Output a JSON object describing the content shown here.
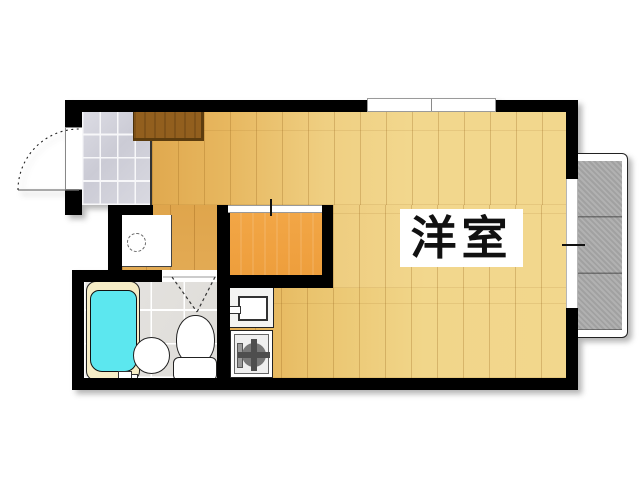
{
  "floorplan": {
    "rooms": {
      "main": {
        "label": "洋室"
      }
    },
    "fixtures": [
      "entrance-door",
      "genkan-tile",
      "shoe-cabinet",
      "washing-machine-space",
      "closet",
      "kitchen-sink",
      "gas-stove",
      "bathtub",
      "washbasin",
      "toilet",
      "bathroom-folding-door",
      "top-window",
      "balcony-window",
      "balcony"
    ],
    "colors": {
      "wall": "#000000",
      "wood_light": "#f2d78d",
      "wood_dark": "#dfa54c",
      "closet": "#ee9e3c",
      "cabinet": "#925f1e",
      "tub": "#5ce7ef",
      "tub_rim": "#f6edc6",
      "balcony": "#ababab",
      "tile_genkan": "#d3d3db",
      "tile_bath": "#e3e1de",
      "label_bg": "#ffffff",
      "label_text": "#111111"
    }
  }
}
